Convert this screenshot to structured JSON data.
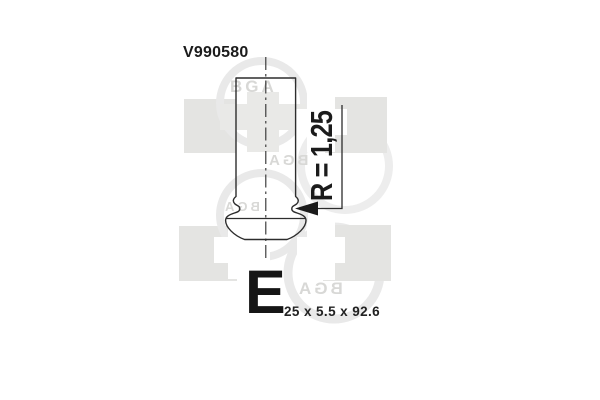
{
  "product": {
    "part_number": "V990580",
    "radius_label": "R = 1,25",
    "size_class": "E",
    "dimensions": "25 x 5.5 x 92.6"
  },
  "watermark": {
    "brand": "BGA",
    "square_color": "#e4e4e2",
    "ring_color": "#e9e9e9",
    "letter_color": "#d8d8d6"
  },
  "drawing": {
    "subject": "engine valve side view with centerline and fillet-radius leader arrow",
    "line_color": "#2d2d2d"
  }
}
